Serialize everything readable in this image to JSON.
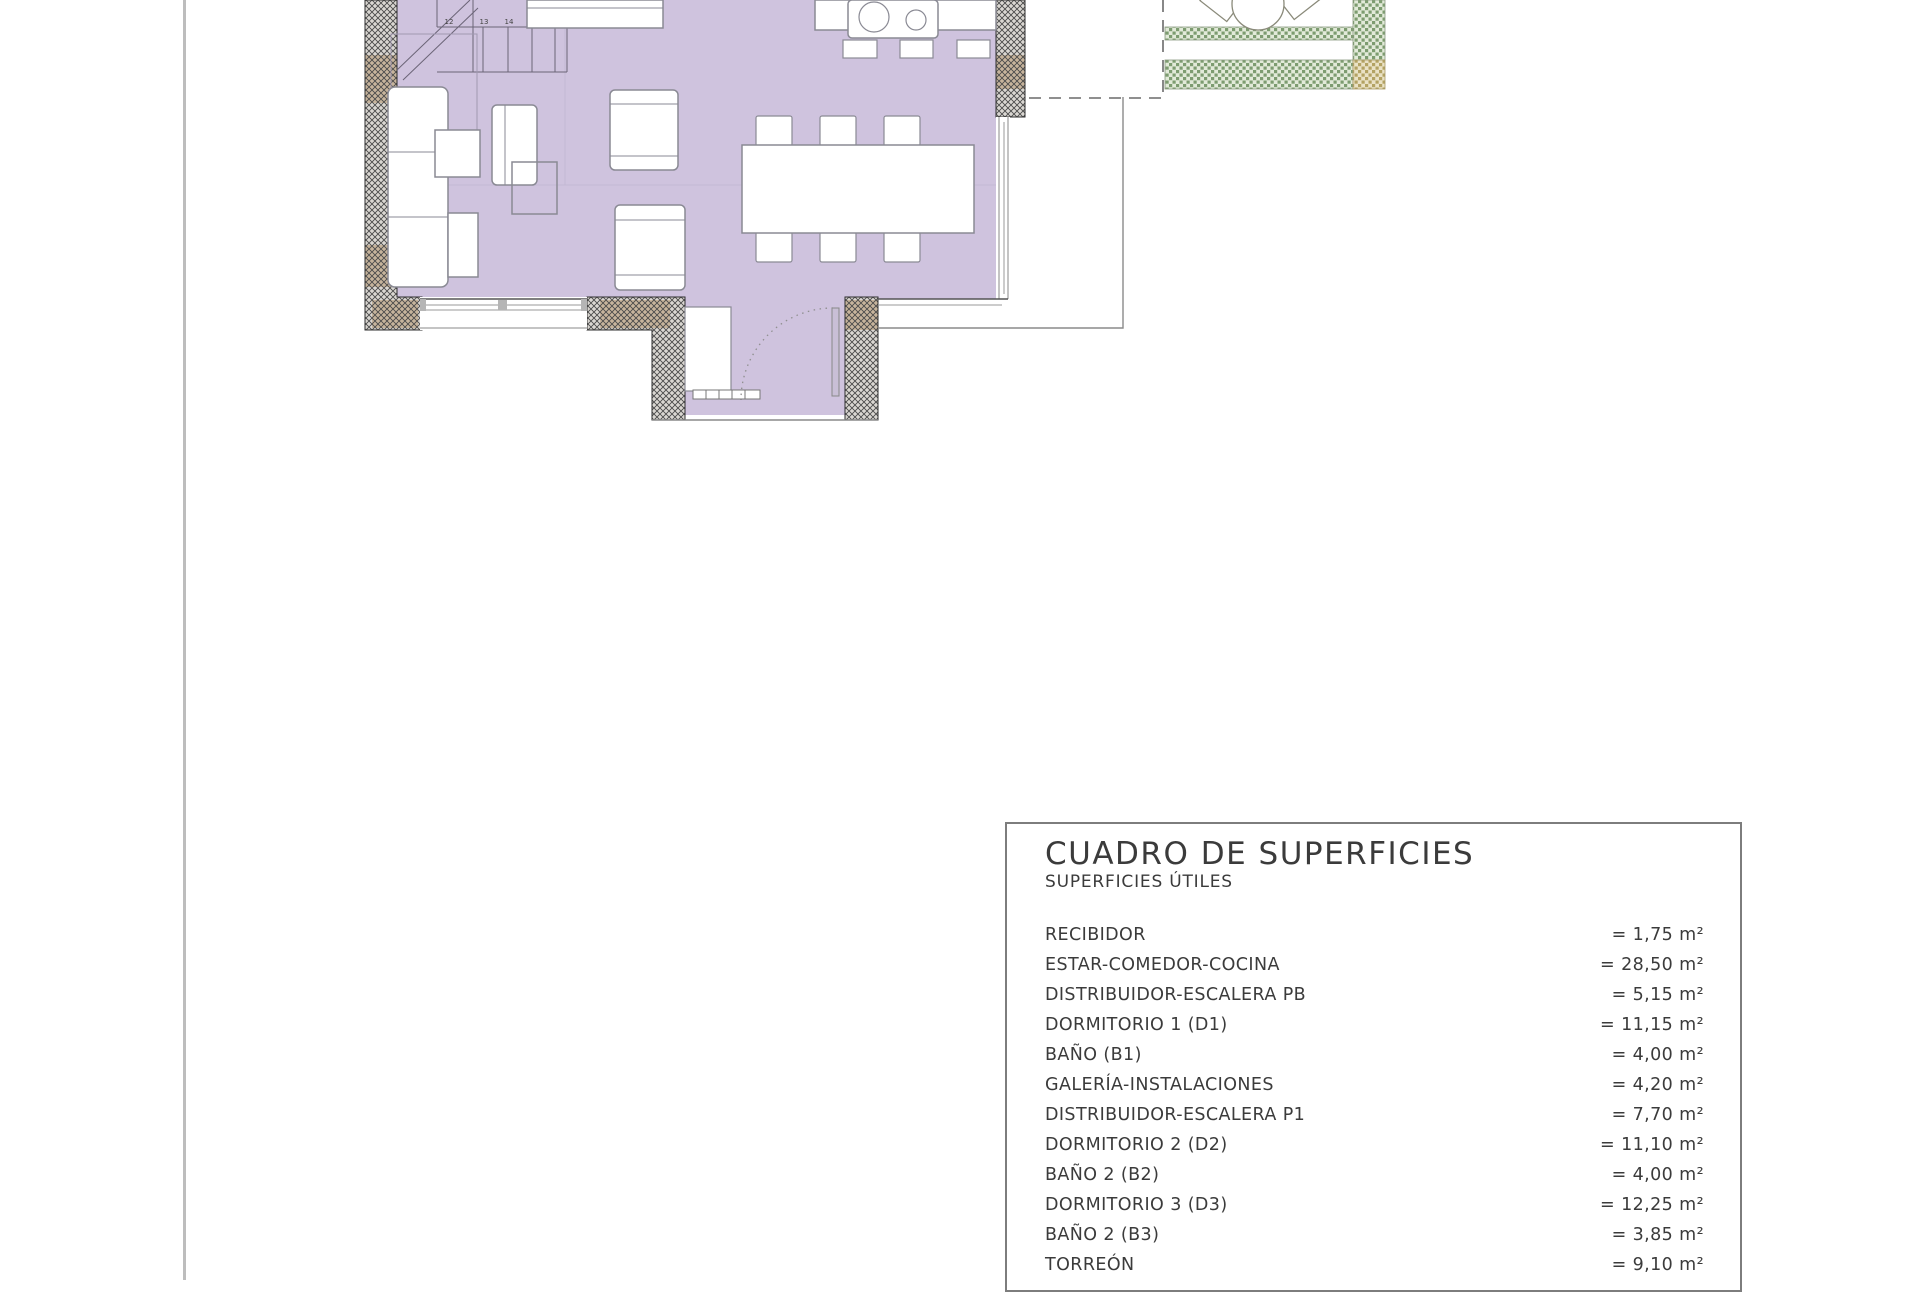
{
  "surfaces_table": {
    "title": "CUADRO DE SUPERFICIES",
    "subtitle": "SUPERFICIES ÚTILES",
    "rows": [
      {
        "label": "RECIBIDOR",
        "value": "= 1,75 m²"
      },
      {
        "label": "ESTAR-COMEDOR-COCINA",
        "value": "= 28,50 m²"
      },
      {
        "label": "DISTRIBUIDOR-ESCALERA PB",
        "value": "= 5,15 m²"
      },
      {
        "label": "DORMITORIO 1 (D1)",
        "value": "= 11,15 m²"
      },
      {
        "label": "BAÑO  (B1)",
        "value": "= 4,00 m²"
      },
      {
        "label": "GALERÍA-INSTALACIONES",
        "value": "= 4,20 m²"
      },
      {
        "label": "DISTRIBUIDOR-ESCALERA P1",
        "value": "= 7,70 m²"
      },
      {
        "label": "DORMITORIO 2 (D2)",
        "value": "= 11,10 m²"
      },
      {
        "label": "BAÑO 2 (B2)",
        "value": "= 4,00 m²"
      },
      {
        "label": "DORMITORIO 3 (D3)",
        "value": "= 12,25 m²"
      },
      {
        "label": "BAÑO 2 (B3)",
        "value": "= 3,85 m²"
      },
      {
        "label": "TORREÓN",
        "value": "= 9,10 m²"
      }
    ]
  },
  "floor_plan": {
    "stair_steps": [
      "12",
      "13",
      "14",
      "15",
      "16"
    ],
    "colors": {
      "floor_lilac": "#cfc3de",
      "wall_hatch_line": "#4a4a4a",
      "wall_base": "#dad7d2",
      "wall_tan_patch": "#b08a5c",
      "hedge_green": "#7d9c70",
      "hedge_green_bg": "#e2ead9",
      "hedge_tan": "#b3a263",
      "hedge_tan_bg": "#eae2c6",
      "furniture_outline": "#8a8a94"
    }
  }
}
